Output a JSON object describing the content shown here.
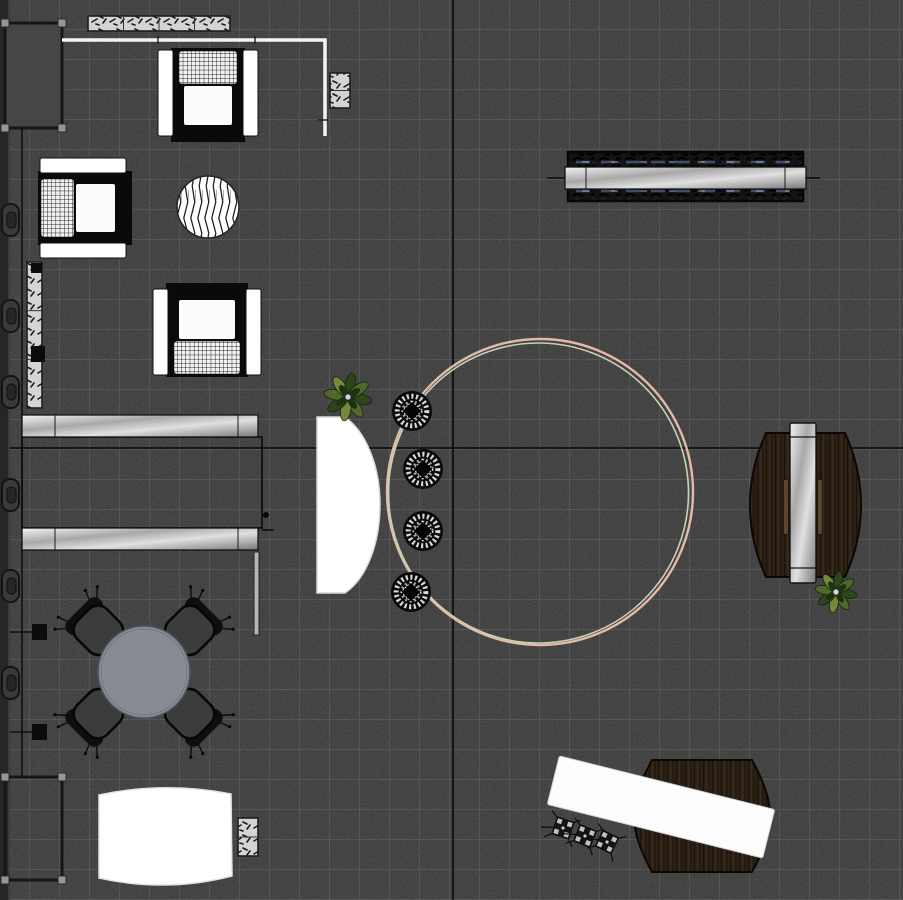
{
  "meta": {
    "view": "furniture-floor-plan",
    "canvas": {
      "width": 903,
      "height": 900
    }
  },
  "palette": {
    "floor": "#3a3a3a",
    "grid_line": "rgba(225,225,225,0.22)",
    "axis_line": "#101010",
    "wall": "#262626",
    "white": "#ffffff",
    "metal_light": "#f4f4f4",
    "metal_dark": "#787878",
    "wood_light": "#3b2c1c",
    "wood_dark": "#140e07",
    "ring_outer": "#e5b9a9",
    "ring_inner": "#c6d2b2",
    "table_top": "#878b93",
    "seat_dark": "#3c3c3c",
    "plant_green": "#50682a",
    "hatch_bg": "#d4d4d4"
  },
  "floor": {
    "tile_px": 30,
    "axis_vertical_x": 453,
    "axis_horizontal_y": 448
  },
  "items": [
    {
      "type": "wall",
      "name": "left-wall",
      "x": 0,
      "y": 0,
      "w": 10,
      "h": 900
    },
    {
      "type": "handles",
      "name": "wall-handles",
      "x": 2,
      "ys": [
        220,
        316,
        392,
        495,
        586,
        683
      ]
    },
    {
      "type": "frame",
      "name": "glass-panel-top-left",
      "x": 5,
      "y": 23,
      "w": 57,
      "h": 105,
      "filled": true
    },
    {
      "type": "frame",
      "name": "glass-panel-bottom-left",
      "x": 5,
      "y": 777,
      "w": 57,
      "h": 103,
      "filled": false
    },
    {
      "type": "guide",
      "name": "guide-line-left",
      "x": 22,
      "y1": 128,
      "y2": 777,
      "squares": [
        632,
        732
      ]
    },
    {
      "type": "hatchrect",
      "name": "hatch-strip-top",
      "x": 88,
      "y": 16,
      "w": 142,
      "h": 15,
      "segments": 4
    },
    {
      "type": "hatchrect",
      "name": "hatch-strip-left",
      "x": 27,
      "y": 262,
      "w": 15,
      "h": 146,
      "segments": 3,
      "markers": [
        [
          31,
          263,
          11,
          10
        ],
        [
          31,
          346,
          14,
          16
        ]
      ]
    },
    {
      "type": "wallline",
      "name": "partition-wall-top",
      "points": "62,40 325,40 325,136",
      "ticks": [
        [
          158,
          36,
          0,
          8
        ],
        [
          255,
          36,
          0,
          8
        ],
        [
          318,
          120,
          10,
          0
        ]
      ]
    },
    {
      "type": "hatchrect",
      "name": "hatch-block-column",
      "x": 330,
      "y": 73,
      "w": 20,
      "h": 35,
      "segments": 2
    },
    {
      "type": "armchair",
      "name": "armchair-top",
      "cx": 208,
      "cy": 95,
      "w": 100,
      "h": 94,
      "rot": 0
    },
    {
      "type": "armchair",
      "name": "armchair-left",
      "cx": 85,
      "cy": 208,
      "w": 100,
      "h": 94,
      "rot": -90
    },
    {
      "type": "armchair",
      "name": "armchair-middle",
      "cx": 207,
      "cy": 330,
      "w": 108,
      "h": 94,
      "rot": 180
    },
    {
      "type": "striped_circle",
      "name": "round-side-table",
      "cx": 208,
      "cy": 207,
      "r": 31
    },
    {
      "type": "console",
      "name": "console-shelf-top-right",
      "dark": {
        "x": 568,
        "y": 152,
        "w": 235,
        "h": 49
      },
      "beam": {
        "x": 565,
        "y": 167,
        "w": 241,
        "h": 22
      },
      "ticks": [
        [
          547,
          178,
          565,
          178
        ],
        [
          806,
          178,
          820,
          178
        ]
      ],
      "dash_ys": [
        162,
        191
      ]
    },
    {
      "type": "shelf_unit",
      "name": "shelf-unit-left",
      "outline": {
        "x": 22,
        "y": 437,
        "w": 240,
        "h": 91
      },
      "beams": [
        {
          "x": 22,
          "y": 415,
          "w": 236,
          "h": 22
        },
        {
          "x": 22,
          "y": 528,
          "w": 236,
          "h": 22
        }
      ],
      "partition": {
        "x": 254,
        "y": 552,
        "w": 5,
        "h": 83
      },
      "dot": [
        266,
        515
      ],
      "tick": [
        262,
        530,
        274,
        530
      ]
    },
    {
      "type": "ring",
      "name": "circular-rug",
      "cx": 540,
      "cy": 492,
      "r_outer": 153,
      "r_inner": 150
    },
    {
      "type": "pathshape",
      "name": "reception-desk",
      "path": "M317,417 L345,417 C366,432 380,466 380,504 C380,543 367,578 345,593 L317,593 Z",
      "fill": "#ffffff",
      "stroke": "#d8d8d8"
    },
    {
      "type": "plant",
      "name": "plant-reception",
      "cx": 348,
      "cy": 397,
      "r": 23
    },
    {
      "type": "stool",
      "name": "stool-1",
      "cx": 412,
      "cy": 411,
      "r": 20
    },
    {
      "type": "stool",
      "name": "stool-2",
      "cx": 423,
      "cy": 469,
      "r": 20
    },
    {
      "type": "stool",
      "name": "stool-3",
      "cx": 423,
      "cy": 531,
      "r": 20
    },
    {
      "type": "stool",
      "name": "stool-4",
      "cx": 411,
      "cy": 592,
      "r": 20
    },
    {
      "type": "pathshape",
      "name": "side-desk-right-wood",
      "path": "M766,433 L845,433 C856,457 861,481 861,505 C861,529 856,553 845,577 L766,577 C755,553 750,529 750,505 C750,481 755,457 766,433 Z",
      "fill": "url(#wood)",
      "stroke": "#0b0704",
      "sw": 2
    },
    {
      "type": "rot_rect",
      "name": "side-desk-slat-left",
      "cx": 786,
      "cy": 507,
      "w": 5,
      "h": 55,
      "rot": 0,
      "fill": "#5a452e",
      "stroke": "#1a120b",
      "sw": 0.8
    },
    {
      "type": "rot_rect",
      "name": "side-desk-slat-right",
      "cx": 820,
      "cy": 507,
      "w": 5,
      "h": 55,
      "rot": 0,
      "fill": "#5a452e",
      "stroke": "#1a120b",
      "sw": 0.8
    },
    {
      "type": "rot_rect",
      "name": "side-desk-metal-bar",
      "cx": 803,
      "cy": 503,
      "w": 26,
      "h": 160,
      "rot": 0,
      "fill": "url(#metalD)",
      "stroke": "#141414",
      "sw": 1.4
    },
    {
      "type": "lines",
      "name": "side-desk-bar-dividers",
      "color": "#141414",
      "w": 1.2,
      "segs": [
        [
          790,
          437,
          816,
          437
        ],
        [
          790,
          568,
          816,
          568
        ]
      ]
    },
    {
      "type": "plant",
      "name": "plant-side-desk",
      "cx": 836,
      "cy": 592,
      "r": 20
    },
    {
      "type": "dining_set",
      "name": "dining-set",
      "cx": 144,
      "cy": 672,
      "r": 46,
      "chairs": [
        [
          98,
          630,
          -45
        ],
        [
          190,
          630,
          45
        ],
        [
          98,
          714,
          -135
        ],
        [
          190,
          714,
          135
        ]
      ]
    },
    {
      "type": "pathshape",
      "name": "table-bottom-white",
      "path": "M99,795 Q165,781 231,794 L232,876 Q166,893 99,878 Z",
      "fill": "#ffffff",
      "stroke": "#e3e3e3"
    },
    {
      "type": "hatchrect",
      "name": "hatch-block-bottom",
      "x": 238,
      "y": 818,
      "w": 20,
      "h": 38,
      "segments": 2
    },
    {
      "type": "pathshape",
      "name": "wood-rug-bottom-right",
      "path": "M652,760 L752,760 C764,782 770,799 770,816 C770,833 764,850 752,872 L652,872 C640,850 634,833 634,816 C634,799 640,782 652,760 Z",
      "fill": "url(#wood)",
      "stroke": "#0b0704",
      "sw": 2
    },
    {
      "type": "rot_rect",
      "name": "desk-bottom-right",
      "cx": 661,
      "cy": 807,
      "w": 222,
      "h": 50,
      "rot": 14,
      "fill": "#fdfdfd",
      "stroke": "#cfcfcf",
      "sw": 1
    },
    {
      "type": "task_chair",
      "name": "task-chair-1",
      "cx": 563,
      "cy": 828,
      "rot": 18
    },
    {
      "type": "task_chair",
      "name": "task-chair-2",
      "cx": 585,
      "cy": 836,
      "rot": 22
    },
    {
      "type": "task_chair",
      "name": "task-chair-3",
      "cx": 607,
      "cy": 842,
      "rot": 26
    }
  ]
}
